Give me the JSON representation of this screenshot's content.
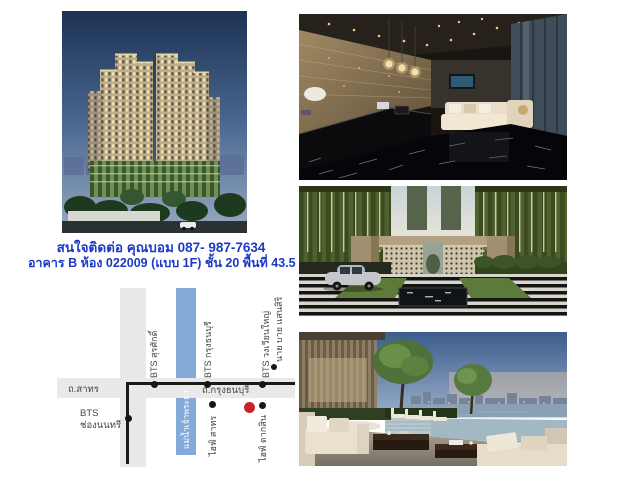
{
  "page": {
    "background": "#ffffff",
    "width": 640,
    "height": 480
  },
  "contact": {
    "line1": "สนใจติดต่อ คุณบอม 087- 987-7634",
    "line2": "อาคาร B ห้อง 022009 (แบบ 1F) ชั้น 20 พื้นที่ 43.5",
    "color": "#1c3ac6"
  },
  "map": {
    "colors": {
      "road": "#e9e9e9",
      "river": "#83aad8",
      "rail_line": "#1a1a1a",
      "station_dot": "#161616",
      "project_marker": "#cc2127",
      "label": "#454545",
      "river_label": "#ffffff"
    },
    "labels": {
      "road_sathorn": "ถ.สาทร",
      "road_krungthonburi": "ถ.กรุงธนบุรี",
      "bts_chongnonsi_line1": "BTS",
      "bts_chongnonsi_line2": "ช่องนนทรี",
      "bts_surasak": "BTS สุรศักดิ์",
      "bts_krungthonburi": "BTS กรุงธนบุรี",
      "bts_wongwianyai": "BTS วงเวียนใหญ่",
      "landmark_nye_sansiri": "นาย บาย แสนสิริ",
      "river": "แม่น้ำเจ้าพระยา",
      "landmark_hive_sathorn": "ไฮฟ์ สาทร",
      "landmark_hive_taksin": "ไฮฟ์ ตากสิน"
    }
  }
}
